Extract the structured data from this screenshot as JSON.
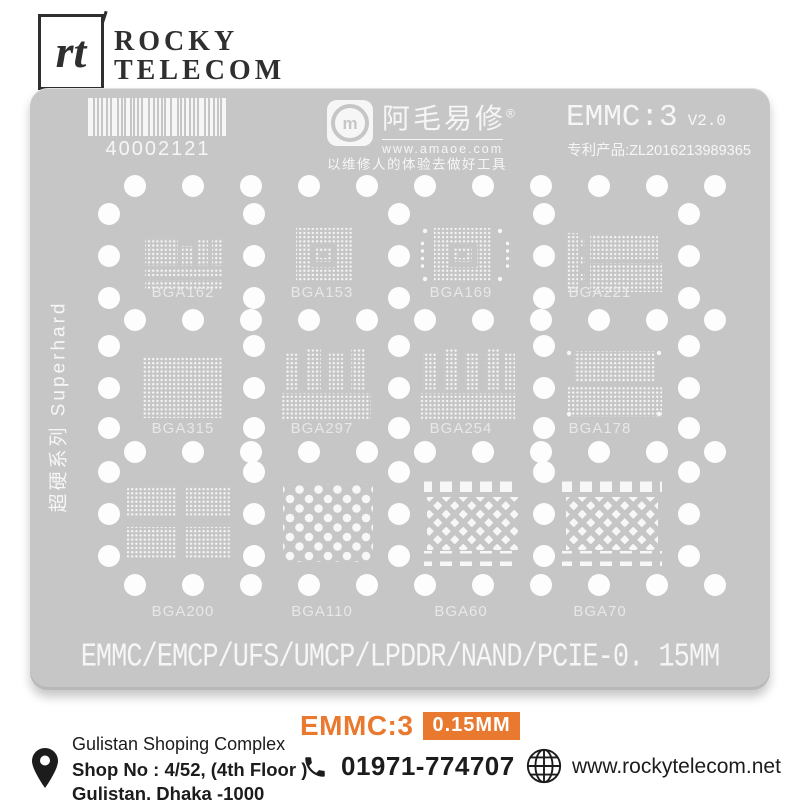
{
  "header": {
    "logo_text": "rt",
    "brand_line1": "ROCKY",
    "brand_line2": "TELECOM"
  },
  "stencil": {
    "plate_color": "#c6c6c6",
    "marking_color": "#f7f7f7",
    "barcode": {
      "number": "40002121",
      "bars": [
        3,
        1,
        1,
        2,
        1,
        3,
        1,
        1,
        2,
        1,
        1,
        1,
        3,
        2,
        1,
        1,
        1,
        2,
        3,
        1,
        1,
        2,
        1,
        1,
        3,
        1,
        2,
        1,
        1,
        2
      ]
    },
    "brand": {
      "name_cn": "阿毛易修",
      "reg": "®",
      "url": "www.amaoe.com",
      "slogan": "以维修人的体验去做好工具"
    },
    "model": "EMMC:3",
    "version": "V2.0",
    "patent": "专利产品:ZL2016213989365",
    "side_text": "超硬系列 Superhard",
    "bottom_text": "EMMC/EMCP/UFS/UMCP/LPDDR/NAND/PCIE-0. 15MM",
    "grid": {
      "hole_radius": 11,
      "a_rows": {
        "ys": [
          186,
          320,
          452,
          585
        ],
        "xs": [
          135,
          193,
          251,
          309,
          367,
          425,
          483,
          541,
          599,
          657,
          715
        ]
      },
      "b_rows": {
        "ys": [
          214,
          256,
          298,
          346,
          388,
          428,
          472,
          514,
          556
        ],
        "xs": [
          109,
          254,
          399,
          544,
          689
        ]
      }
    },
    "patterns": [
      {
        "label": "BGA162",
        "lx": 183,
        "ly": 297,
        "blocks": [
          [
            145,
            238,
            33,
            28,
            "dots"
          ],
          [
            182,
            246,
            11,
            20,
            "dots"
          ],
          [
            197,
            240,
            11,
            26,
            "dots"
          ],
          [
            212,
            238,
            10,
            28,
            "dots"
          ],
          [
            145,
            268,
            77,
            9,
            "dots"
          ],
          [
            145,
            280,
            77,
            10,
            "dots"
          ]
        ]
      },
      {
        "label": "BGA153",
        "lx": 322,
        "ly": 297,
        "blocks": [
          [
            296,
            228,
            56,
            54,
            "dots"
          ],
          [
            311,
            243,
            26,
            24,
            "punch"
          ],
          [
            316,
            248,
            16,
            14,
            "dots"
          ],
          [
            320,
            252,
            8,
            6,
            "punch"
          ]
        ]
      },
      {
        "label": "BGA169",
        "lx": 461,
        "ly": 297,
        "blocks": [
          [
            434,
            228,
            58,
            54,
            "dots"
          ],
          [
            449,
            243,
            28,
            24,
            "punch"
          ],
          [
            454,
            248,
            18,
            14,
            "dots"
          ],
          [
            459,
            252,
            8,
            6,
            "punch"
          ],
          [
            420,
            240,
            5,
            30,
            "vdash"
          ],
          [
            506,
            240,
            5,
            30,
            "vdash"
          ],
          [
            425,
            231,
            0,
            0,
            "dot"
          ],
          [
            500,
            231,
            0,
            0,
            "dot"
          ],
          [
            425,
            279,
            0,
            0,
            "dot"
          ],
          [
            500,
            279,
            0,
            0,
            "dot"
          ]
        ]
      },
      {
        "label": "BGA221",
        "lx": 600,
        "ly": 297,
        "blocks": [
          [
            566,
            233,
            12,
            59,
            "dots"
          ],
          [
            581,
            238,
            4,
            8,
            "dots"
          ],
          [
            581,
            256,
            4,
            8,
            "dots"
          ],
          [
            581,
            274,
            4,
            8,
            "dots"
          ],
          [
            590,
            234,
            68,
            25,
            "dots"
          ],
          [
            590,
            263,
            72,
            29,
            "dots"
          ]
        ]
      },
      {
        "label": "BGA315",
        "lx": 183,
        "ly": 433,
        "blocks": [
          [
            142,
            356,
            80,
            62,
            "dots"
          ]
        ]
      },
      {
        "label": "BGA297",
        "lx": 322,
        "ly": 433,
        "blocks": [
          [
            285,
            353,
            14,
            38,
            "dots"
          ],
          [
            307,
            349,
            14,
            42,
            "dots"
          ],
          [
            329,
            353,
            14,
            38,
            "dots"
          ],
          [
            351,
            349,
            14,
            42,
            "dots"
          ],
          [
            281,
            393,
            90,
            28,
            "dots"
          ]
        ]
      },
      {
        "label": "BGA254",
        "lx": 461,
        "ly": 433,
        "blocks": [
          [
            423,
            353,
            13,
            38,
            "dots"
          ],
          [
            444,
            349,
            13,
            42,
            "dots"
          ],
          [
            465,
            353,
            13,
            38,
            "dots"
          ],
          [
            486,
            349,
            13,
            42,
            "dots"
          ],
          [
            505,
            353,
            10,
            38,
            "dots"
          ],
          [
            420,
            393,
            95,
            28,
            "dots"
          ]
        ]
      },
      {
        "label": "BGA178",
        "lx": 600,
        "ly": 433,
        "blocks": [
          [
            574,
            351,
            82,
            31,
            "dots"
          ],
          [
            568,
            386,
            94,
            31,
            "dots"
          ],
          [
            569,
            353,
            0,
            0,
            "dot"
          ],
          [
            659,
            353,
            0,
            0,
            "dot"
          ],
          [
            569,
            414,
            0,
            0,
            "dot"
          ],
          [
            659,
            414,
            0,
            0,
            "dot"
          ]
        ]
      },
      {
        "label": "BGA200",
        "lx": 183,
        "ly": 616,
        "blocks": [
          [
            127,
            486,
            50,
            31,
            "dots"
          ],
          [
            186,
            486,
            45,
            31,
            "dots"
          ],
          [
            127,
            527,
            50,
            31,
            "dots"
          ],
          [
            186,
            527,
            45,
            31,
            "dots"
          ]
        ]
      },
      {
        "label": "BGA110",
        "lx": 322,
        "ly": 616,
        "blocks": [
          [
            283,
            484,
            90,
            78,
            "bigdots"
          ]
        ]
      },
      {
        "label": "BGA60",
        "lx": 461,
        "ly": 616,
        "blocks": [
          [
            424,
            477,
            96,
            15,
            "squares"
          ],
          [
            427,
            497,
            91,
            53,
            "diamonds"
          ],
          [
            424,
            551,
            96,
            15,
            "squares"
          ]
        ]
      },
      {
        "label": "BGA70",
        "lx": 600,
        "ly": 616,
        "blocks": [
          [
            562,
            477,
            100,
            15,
            "squares"
          ],
          [
            566,
            497,
            92,
            53,
            "diamonds"
          ],
          [
            562,
            551,
            100,
            15,
            "squares"
          ]
        ]
      }
    ]
  },
  "footer": {
    "address": {
      "line1": "Gulistan Shoping Complex",
      "line2": "Shop No : 4/52, (4th Floor )",
      "line3": "Gulistan, Dhaka -1000"
    },
    "product": {
      "name": "EMMC:3",
      "badge": "0.15MM"
    },
    "phone": "01971-774707",
    "website": "www.rockytelecom.net"
  },
  "colors": {
    "accent_orange": "#e8792f",
    "text_dark": "#1c1c1c",
    "plate_gray": "#c6c6c6"
  }
}
